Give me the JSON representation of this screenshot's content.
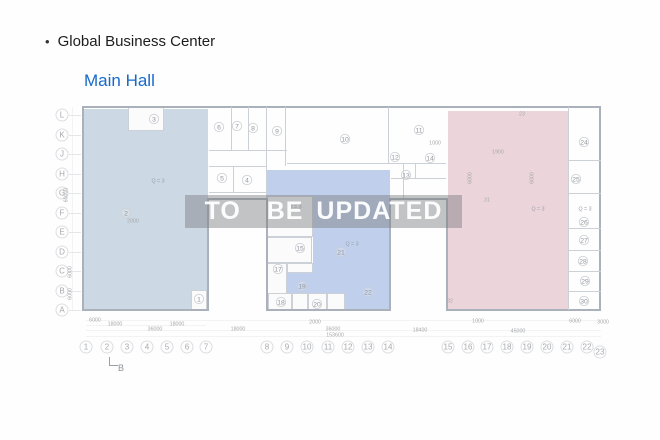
{
  "page": {
    "bullet": "•",
    "title": "Global Business Center",
    "subtitle": "Main Hall"
  },
  "watermark": {
    "text": "TO  BE UPDATED"
  },
  "colors": {
    "accent_blue": "#1769c9",
    "left_region": "#ccd8e3",
    "middle_region": "#bfcfec",
    "right_region": "#ecd4db"
  },
  "plan": {
    "grid_rows": [
      "L",
      "K",
      "J",
      "H",
      "G",
      "F",
      "E",
      "D",
      "C",
      "B",
      "A"
    ],
    "grid_columns": [
      "1",
      "2",
      "3",
      "4",
      "5",
      "6",
      "7",
      "8",
      "9",
      "10",
      "11",
      "12",
      "13",
      "14",
      "15",
      "16",
      "17",
      "18",
      "19",
      "20",
      "21",
      "22",
      "23"
    ],
    "room_numbers": [
      "1",
      "2",
      "3",
      "4",
      "5",
      "6",
      "7",
      "8",
      "9",
      "10",
      "11",
      "12",
      "13",
      "14",
      "15",
      "17",
      "18",
      "19",
      "20",
      "21",
      "22",
      "24",
      "25",
      "26",
      "27",
      "28",
      "29",
      "30"
    ],
    "plain_labels": [
      "23",
      "31",
      "32"
    ],
    "area_labels": [
      "Q = 3",
      "Q = 3",
      "Q = 3",
      "Q = 3",
      "Q = 3"
    ],
    "dimensions": [
      "6000",
      "18000",
      "18000",
      "36000",
      "18000",
      "2000",
      "36000",
      "18400",
      "45000",
      "1000",
      "6000",
      "3000",
      "153600",
      "60000",
      "6000",
      "6000",
      "2000",
      "1000",
      "1900",
      "6000",
      "6000"
    ],
    "section_marker": "B"
  }
}
